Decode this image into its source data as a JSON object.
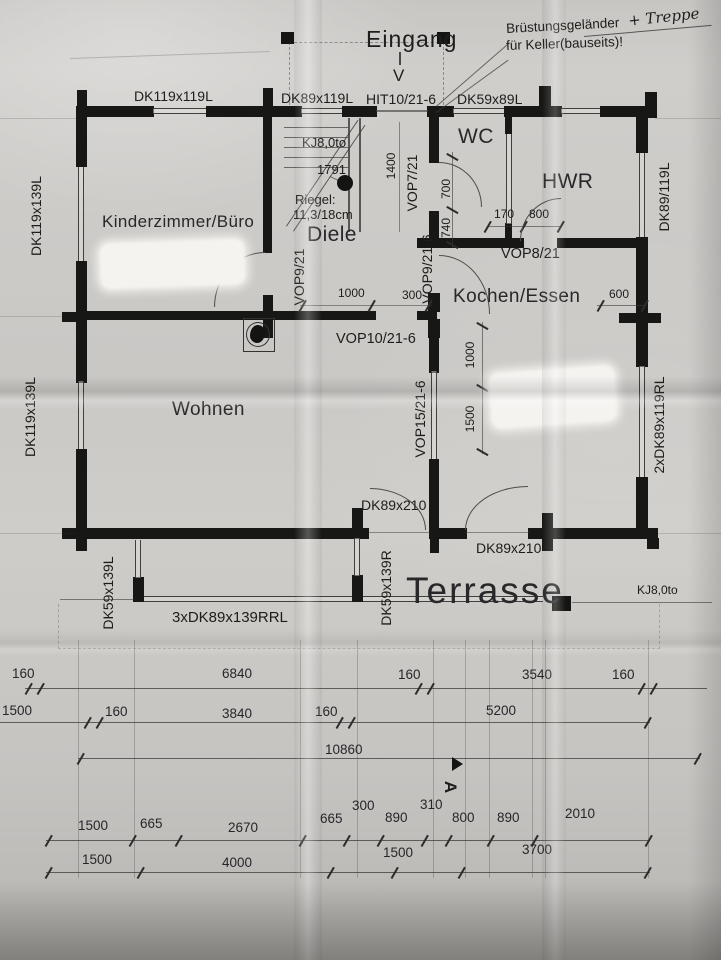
{
  "plan": {
    "entrance": {
      "label": "Eingang",
      "arrow": "V"
    },
    "note": {
      "line1a": "Brüstungsgeländer",
      "line1b": "+ Treppe",
      "line2": "für Keller(bauseits)!"
    },
    "rooms": {
      "kinderzimmer": "Kinderzimmer/Büro",
      "diele": "Diele",
      "wc": "WC",
      "hwr": "HWR",
      "kochen": "Kochen/Essen",
      "wohnen": "Wohnen",
      "terrasse": "Terrasse"
    },
    "windows_doors": {
      "top": [
        "DK119x119L",
        "DK89x119L",
        "HIT10/21-6",
        "DK59x89L"
      ],
      "left": [
        "DK119x139L",
        "DK119x139L"
      ],
      "right": [
        "DK89/119L",
        "2xDK89x119RL"
      ],
      "interior": [
        "VOP7/21",
        "VOP8/21",
        "VOP9/21",
        "VOP9/21-6",
        "VOP10/21-6",
        "VOP15/21-6"
      ],
      "terrace": [
        "DK89x210",
        "DK89x210",
        "DK59x139L",
        "DK59x139R",
        "3xDK89x139RRL"
      ],
      "roof": [
        "KJ8,0to",
        "KJ8,0to"
      ]
    },
    "annotations": {
      "stair_number": "1791",
      "riegel_line1": "Riegel:",
      "riegel_line2": "11,3/18cm",
      "section_marker": "A"
    },
    "inner_dims": {
      "d1400": "1400",
      "d700": "700",
      "d740": "740",
      "d170": "170",
      "d800": "800",
      "d1000_kueche": "1000",
      "d300": "300",
      "d600": "600",
      "d1000_v": "1000",
      "d1500_v": "1500"
    }
  },
  "dims": {
    "row1": [
      "160",
      "6840",
      "160",
      "3540",
      "160"
    ],
    "row2": [
      "1500",
      "160",
      "3840",
      "160",
      "5200"
    ],
    "row3": [
      "10860"
    ],
    "row4": [
      "1500",
      "665",
      "2670",
      "665",
      "300",
      "890",
      "310",
      "800",
      "890",
      "2010"
    ],
    "row5": [
      "1500",
      "4000",
      "1500",
      "3700"
    ]
  },
  "colors": {
    "paper": "#c9c7c3",
    "ink": "#171715",
    "line": "#3a3a38"
  }
}
